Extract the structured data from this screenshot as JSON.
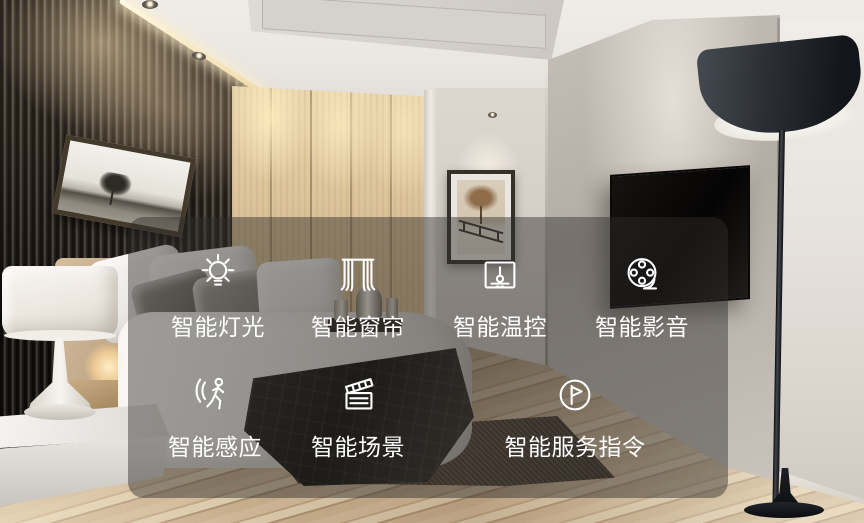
{
  "overlay": {
    "panel_color": "rgba(47,45,43,0.46)",
    "text_color": "#ffffff",
    "features": [
      {
        "label": "智能灯光",
        "icon": "light-bulb-icon"
      },
      {
        "label": "智能窗帘",
        "icon": "curtains-icon"
      },
      {
        "label": "智能温控",
        "icon": "thermostat-icon"
      },
      {
        "label": "智能影音",
        "icon": "film-reel-icon"
      },
      {
        "label": "智能感应",
        "icon": "motion-sensor-icon"
      },
      {
        "label": "智能场景",
        "icon": "clapperboard-icon"
      },
      {
        "label": "智能服务指令",
        "icon": "flag-in-circle-icon"
      }
    ]
  },
  "scene": {
    "type": "bedroom-photograph",
    "elements": [
      "slatted-accent-wall",
      "panoramic-tree-artwork",
      "wood-headboard-wall",
      "framed-tree-picture",
      "wall-mounted-tv",
      "black-floor-lamp",
      "bed-with-pillows",
      "dark-throw-blanket",
      "floating-nightstand",
      "white-table-lamp",
      "dark-area-rug",
      "wood-plank-floor",
      "recessed-ceiling-lights"
    ],
    "palette": {
      "wall_gray": "#b9b3ac",
      "wood_panel": "#d9c29a",
      "floor_wood": "#c9b191",
      "rug": "#4a3e33",
      "lamp_shade": "#2b2f35"
    }
  }
}
